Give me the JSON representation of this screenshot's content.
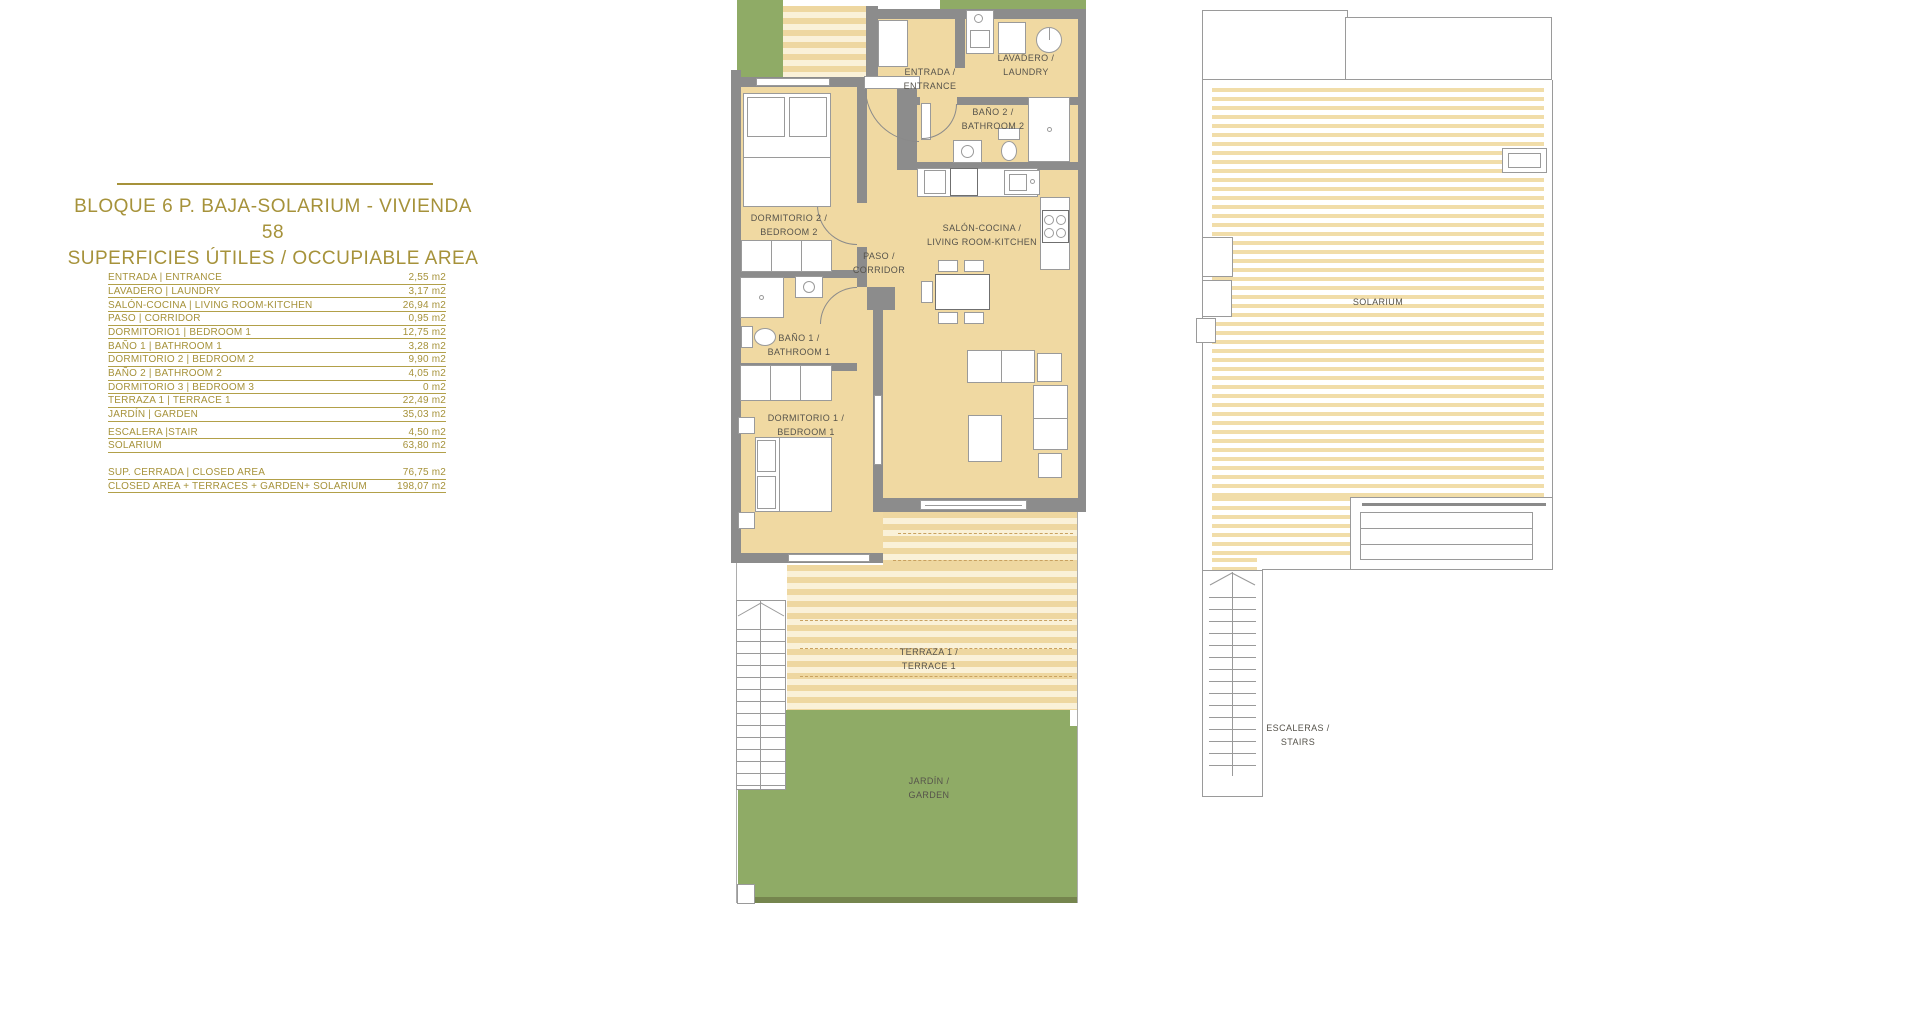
{
  "colors": {
    "gold": "#a6923a",
    "wall_gray": "#8c8c8c",
    "floor_tan": "#f0d9a2",
    "terrace_stripe": "#eed7a0",
    "garden_green": "#8fab66",
    "label_gray": "#56534b"
  },
  "panel": {
    "title_line1": "BLOQUE 6 P. BAJA-SOLARIUM - VIVIENDA 58",
    "title_line2": "SUPERFICIES ÚTILES / OCCUPIABLE AREA",
    "rows": [
      {
        "label": "ENTRADA | ENTRANCE",
        "value": "2,55 m2"
      },
      {
        "label": "LAVADERO | LAUNDRY",
        "value": "3,17 m2"
      },
      {
        "label": "SALÓN-COCINA | LIVING ROOM-KITCHEN",
        "value": "26,94 m2"
      },
      {
        "label": "PASO | CORRIDOR",
        "value": "0,95 m2"
      },
      {
        "label": "DORMITORIO1 | BEDROOM 1",
        "value": "12,75 m2"
      },
      {
        "label": "BAÑO 1 | BATHROOM 1",
        "value": "3,28 m2"
      },
      {
        "label": "DORMITORIO 2 | BEDROOM 2",
        "value": "9,90 m2"
      },
      {
        "label": "BAÑO 2 | BATHROOM 2",
        "value": "4,05 m2"
      },
      {
        "label": "DORMITORIO 3 | BEDROOM 3",
        "value": "0 m2"
      },
      {
        "label": "TERRAZA 1 | TERRACE 1",
        "value": "22,49 m2"
      },
      {
        "label": "JARDÍN | GARDEN",
        "value": "35,03 m2"
      },
      {
        "label": "ESCALERA |STAIR",
        "value": "4,50 m2"
      },
      {
        "label": "SOLARIUM",
        "value": "63,80 m2"
      }
    ],
    "summary_rows": [
      {
        "label": "SUP. CERRADA | CLOSED AREA",
        "value": "76,75 m2"
      },
      {
        "label": "CLOSED AREA + TERRACES + GARDEN+ SOLARIUM",
        "value": "198,07 m2"
      }
    ]
  },
  "floor_plan": {
    "rooms": {
      "entrance": {
        "line1": "ENTRADA /",
        "line2": "ENTRANCE"
      },
      "laundry": {
        "line1": "LAVADERO /",
        "line2": "LAUNDRY"
      },
      "bathroom2": {
        "line1": "BAÑO 2 /",
        "line2": "BATHROOM 2"
      },
      "bedroom2": {
        "line1": "DORMITORIO 2 /",
        "line2": "BEDROOM 2"
      },
      "corridor": {
        "line1": "PASO /",
        "line2": "CORRIDOR"
      },
      "living": {
        "line1": "SALÓN-COCINA /",
        "line2": "LIVING ROOM-KITCHEN"
      },
      "bathroom1": {
        "line1": "BAÑO 1 /",
        "line2": "BATHROOM 1"
      },
      "bedroom1": {
        "line1": "DORMITORIO 1 /",
        "line2": "BEDROOM 1"
      },
      "terrace": {
        "line1": "TERRAZA 1 /",
        "line2": "TERRACE 1"
      },
      "garden": {
        "line1": "JARDÍN /",
        "line2": "GARDEN"
      }
    }
  },
  "solarium_plan": {
    "solarium_label": "SOLARIUM",
    "stairs": {
      "line1": "ESCALERAS /",
      "line2": "STAIRS"
    }
  }
}
